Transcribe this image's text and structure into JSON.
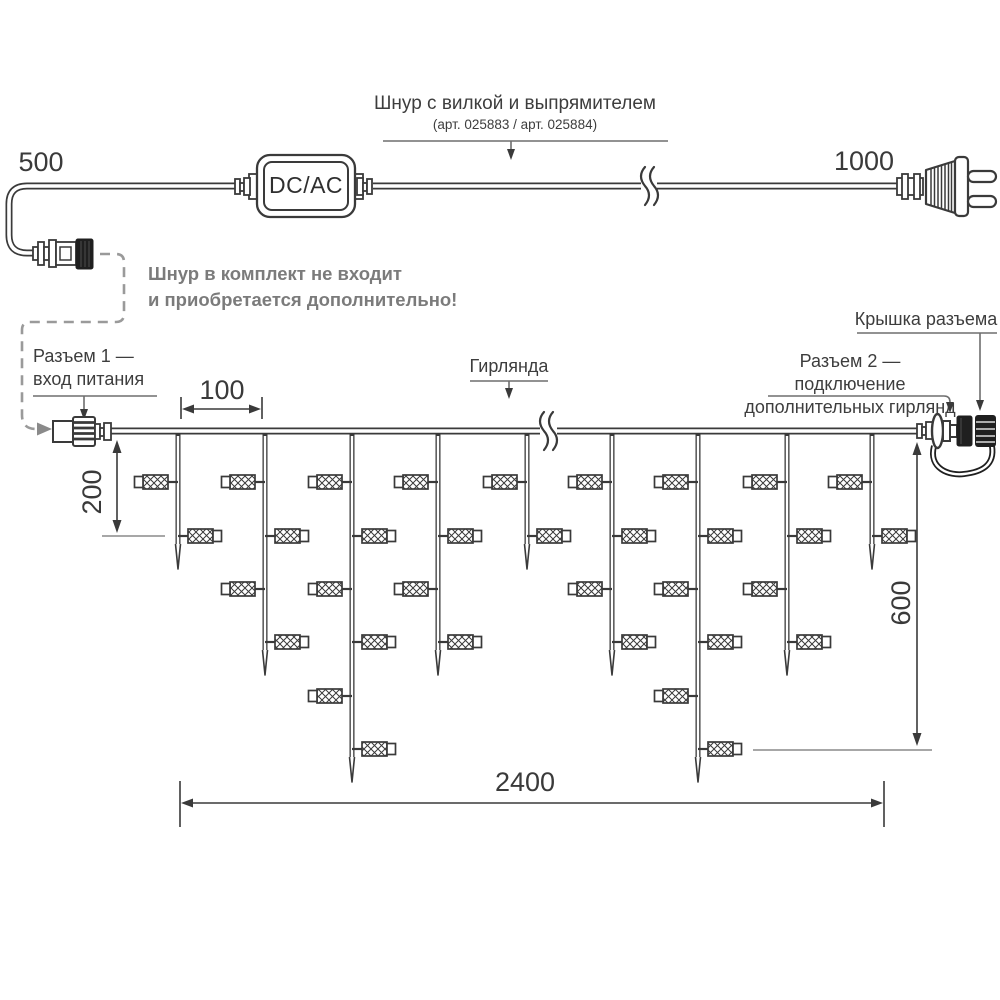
{
  "colors": {
    "ink": "#3a3a3a",
    "leader_gray": "#6e6e6e",
    "tick_gray": "#8a8a8a",
    "note_gray": "#7b7b7b",
    "black_fill": "#1f1f1f"
  },
  "power_cord": {
    "label_line1": "Шнур с вилкой и выпрямителем",
    "label_line2": "(арт. 025883 / арт. 025884)",
    "converter_label": "DC/AC",
    "left_length": "500",
    "right_length": "1000",
    "note_line1": "Шнур в комплект не входит",
    "note_line2": "и приобретается дополнительно!"
  },
  "garland": {
    "connector1_label_line1": "Разъем 1 —",
    "connector1_label_line2": "вход питания",
    "garland_label": "Гирлянда",
    "cap_label": "Крышка разъема",
    "connector2_label_line1": "Разъем 2 — подключение",
    "connector2_label_line2": "дополнительных гирлянд",
    "dim_spacing": "100",
    "dim_short_drop": "200",
    "dim_height": "600",
    "dim_total": "2400",
    "structure": {
      "strand_x": [
        178,
        265,
        352,
        438,
        527,
        612,
        698,
        787,
        872
      ],
      "strand_types": [
        "short",
        "medium",
        "long",
        "medium",
        "short",
        "medium",
        "long",
        "medium",
        "short"
      ],
      "lamp_rows_y": [
        482,
        536,
        589,
        642,
        696,
        749
      ],
      "lamps_per_type": {
        "short": 2,
        "medium": 4,
        "long": 6
      }
    }
  }
}
